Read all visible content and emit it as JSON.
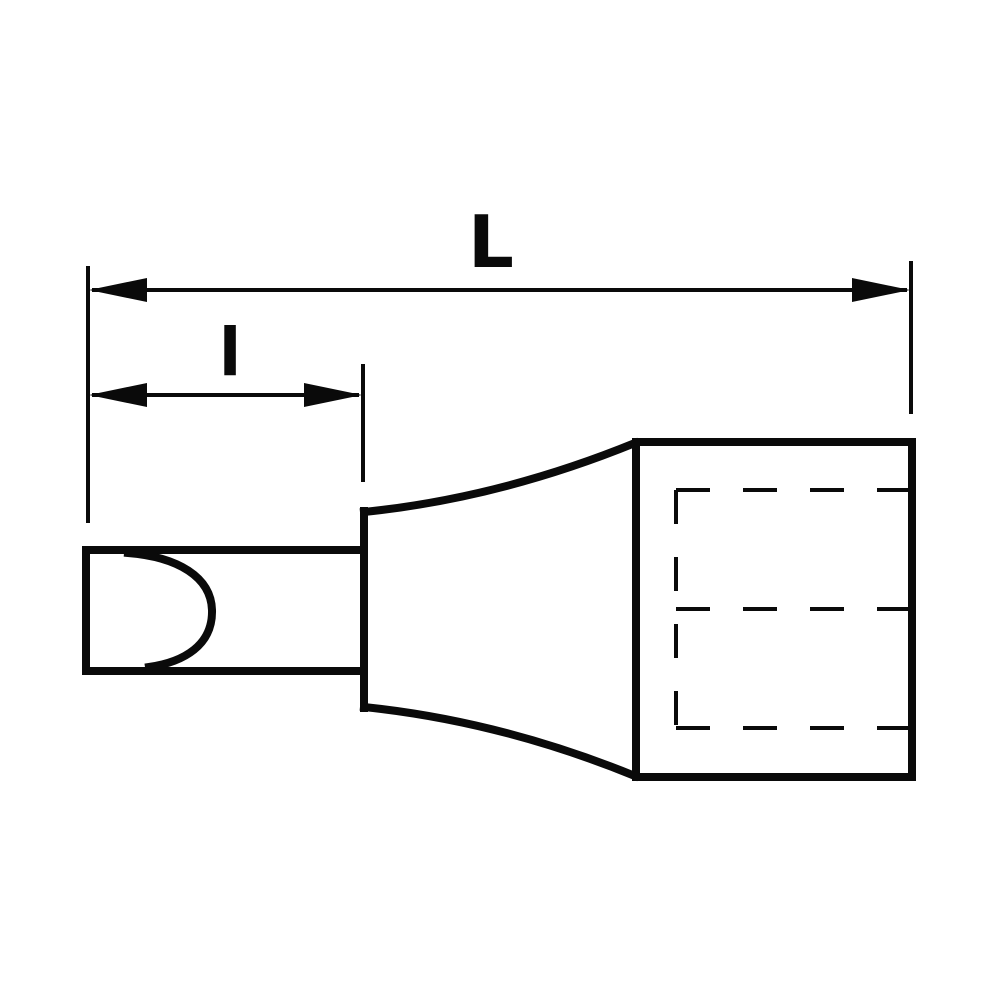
{
  "colors": {
    "ink": "#0a0a0a",
    "background": "#ffffff"
  },
  "dimensions": {
    "overall_length": {
      "label": "L"
    },
    "tip_length": {
      "label": "l"
    }
  }
}
